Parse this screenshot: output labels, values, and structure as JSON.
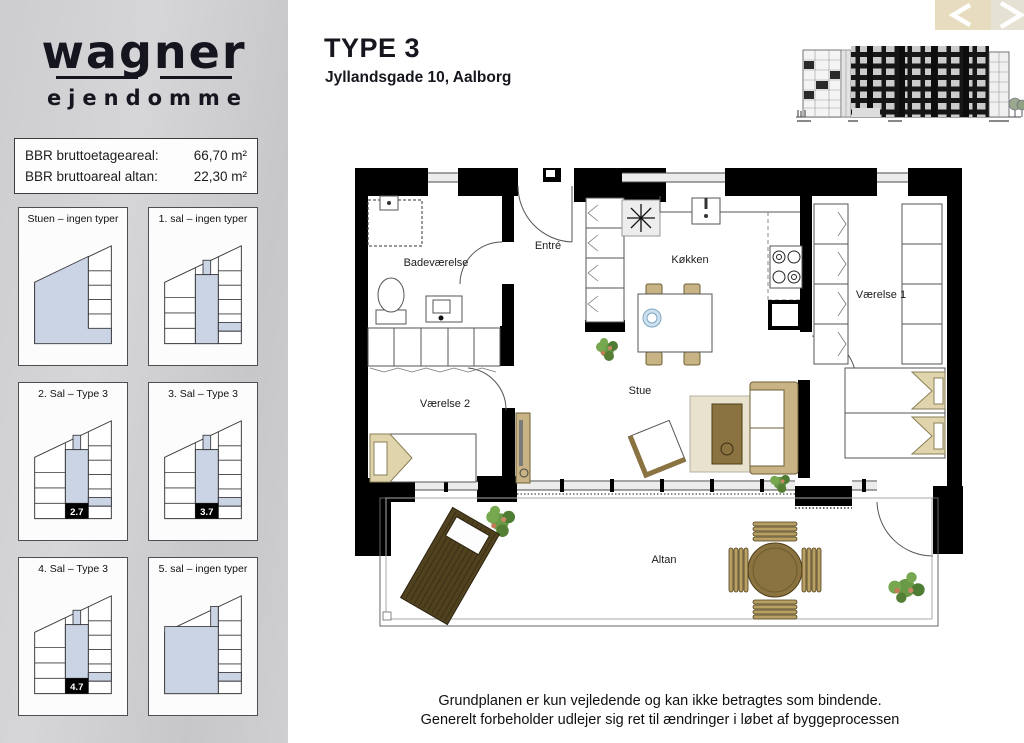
{
  "brand": {
    "name": "wagner",
    "subtitle": "ejendomme"
  },
  "info_box": {
    "rows": [
      {
        "label": "BBR bruttoetageareal:",
        "value": "66,70 m²"
      },
      {
        "label": "BBR bruttoareal altan:",
        "value": "22,30 m²"
      }
    ]
  },
  "floor_cards": [
    {
      "label": "Stuen – ingen typer",
      "badge": null
    },
    {
      "label": "1. sal – ingen typer",
      "badge": null
    },
    {
      "label": "2. Sal – Type 3",
      "badge": "2.7"
    },
    {
      "label": "3. Sal – Type 3",
      "badge": "3.7"
    },
    {
      "label": "4. Sal – Type 3",
      "badge": "4.7"
    },
    {
      "label": "5. sal – ingen typer",
      "badge": null
    }
  ],
  "header": {
    "title": "TYPE 3",
    "subtitle": "Jyllandsgade 10, Aalborg"
  },
  "plan_labels": {
    "bathroom": "Badeværelse",
    "entry": "Entré",
    "kitchen": "Køkken",
    "room1": "Værelse 1",
    "room2": "Værelse 2",
    "living": "Stue",
    "balcony": "Altan"
  },
  "disclaimer": {
    "line1": "Grundplanen er kun vejledende og kan ikke betragtes som bindende.",
    "line2": "Generelt forbeholder udlejer sig ret til ændringer i løbet af byggeprocessen"
  },
  "colors": {
    "sidebar_gray": "#cdcdcf",
    "highlight_blue": "#cad4e4",
    "nav_beige": "#e8dcc0",
    "nav_beige_light": "#e6e2d3",
    "wall_black": "#000000",
    "furniture_tan": "#c7b383",
    "wood_brown": "#8a7340",
    "lounger_brown": "#50411f",
    "plant_green": "#6a9a48",
    "bowl_blue": "#cfe0ee"
  }
}
